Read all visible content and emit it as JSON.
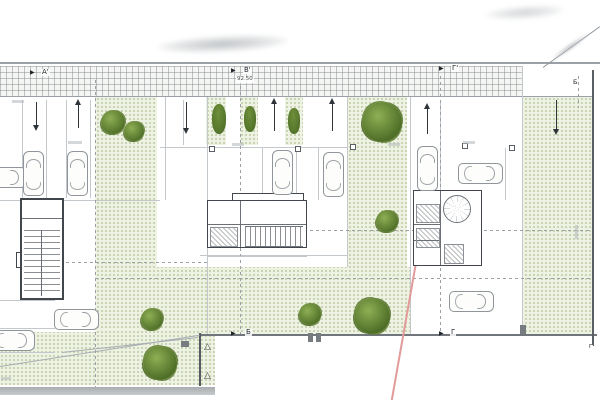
{
  "title": "Architectural site / ground floor parking plan (scanned drawing)",
  "colors": {
    "wall": "#42474d",
    "plan_line": "#c3c8cc",
    "dark_line": "#70767b",
    "green_fill": "#eef2e2",
    "green_dot": "#809858",
    "tree_dark": "#4f6f28",
    "tree_mid": "#6f8f3b",
    "tree_light": "#8fae54",
    "red_line": "#e39a9a",
    "band_line": "#7d8288"
  },
  "markers": {
    "section_a_top": "А'",
    "section_b_top": "В'",
    "section_b_level": "92.50",
    "section_g_top": "Г'",
    "section_b_bottom": "Б",
    "section_g_bottom": "Г",
    "right_edge_b": "Б",
    "right_edge_g": "Г"
  },
  "plan": {
    "cars": [
      {
        "x": -6,
        "y": 155,
        "rot": 90
      },
      {
        "x": 23,
        "y": 151,
        "rot": 0
      },
      {
        "x": 67,
        "y": 151,
        "rot": 0
      },
      {
        "x": 272,
        "y": 150,
        "rot": 0
      },
      {
        "x": 323,
        "y": 152,
        "rot": 0
      },
      {
        "x": 417,
        "y": 146,
        "rot": 0
      },
      {
        "x": 470,
        "y": 151,
        "rot": 90
      },
      {
        "x": 66,
        "y": 297,
        "rot": 90
      },
      {
        "x": 2,
        "y": 318,
        "rot": 90
      },
      {
        "x": 461,
        "y": 279,
        "rot": 90
      }
    ],
    "trees": [
      {
        "x": 113,
        "y": 122,
        "r": 12,
        "type": "bush"
      },
      {
        "x": 134,
        "y": 131,
        "r": 10,
        "type": "bush"
      },
      {
        "x": 219,
        "y": 119,
        "r": 7,
        "type": "cypress"
      },
      {
        "x": 250,
        "y": 119,
        "r": 6,
        "type": "cypress"
      },
      {
        "x": 294,
        "y": 121,
        "r": 6,
        "type": "cypress"
      },
      {
        "x": 382,
        "y": 122,
        "r": 20,
        "type": "big"
      },
      {
        "x": 387,
        "y": 221,
        "r": 11,
        "type": "bush"
      },
      {
        "x": 152,
        "y": 319,
        "r": 11,
        "type": "bush"
      },
      {
        "x": 160,
        "y": 363,
        "r": 17,
        "type": "big"
      },
      {
        "x": 310,
        "y": 314,
        "r": 11,
        "type": "bush"
      },
      {
        "x": 372,
        "y": 316,
        "r": 18,
        "type": "big"
      }
    ],
    "arrows": [
      {
        "x": 36,
        "y": 100,
        "h": 30,
        "dir": "down"
      },
      {
        "x": 78,
        "y": 100,
        "h": 30,
        "dir": "up"
      },
      {
        "x": 186,
        "y": 100,
        "h": 33,
        "dir": "down"
      },
      {
        "x": 274,
        "y": 99,
        "h": 34,
        "dir": "up"
      },
      {
        "x": 332,
        "y": 99,
        "h": 34,
        "dir": "up"
      },
      {
        "x": 427,
        "y": 104,
        "h": 32,
        "dir": "up"
      },
      {
        "x": 556,
        "y": 98,
        "h": 36,
        "dir": "down"
      }
    ]
  }
}
